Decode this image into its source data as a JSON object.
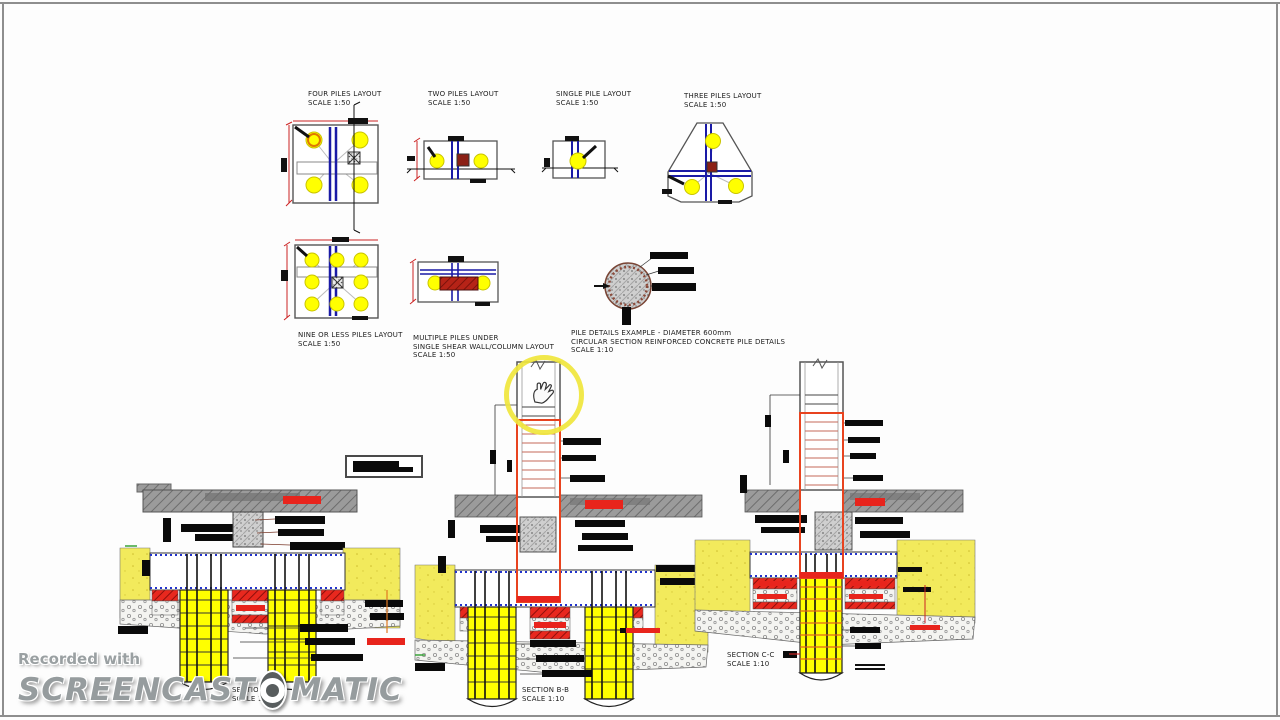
{
  "canvas": {
    "background": "#fdfdfd",
    "frame_color": "#8e8e8e"
  },
  "layouts": {
    "four": {
      "title": "FOUR PILES LAYOUT",
      "scale": "SCALE 1:50"
    },
    "two": {
      "title": "TWO PILES LAYOUT",
      "scale": "SCALE 1:50"
    },
    "single": {
      "title": "SINGLE PILE LAYOUT",
      "scale": "SCALE 1:50"
    },
    "three": {
      "title": "THREE PILES LAYOUT",
      "scale": "SCALE 1:50"
    },
    "nine": {
      "title": "NINE OR LESS PILES LAYOUT",
      "scale": "SCALE 1:50"
    },
    "multiple": {
      "title1": "MULTIPLE PILES UNDER",
      "title2": "SINGLE SHEAR WALL/COLUMN LAYOUT",
      "scale": "SCALE 1:50"
    },
    "pile_detail": {
      "title1": "PILE DETAILS EXAMPLE -  DIAMETER 600mm",
      "title2": "CIRCULAR SECTION REINFORCED CONCRETE PILE DETAILS",
      "scale": "SCALE 1:10"
    }
  },
  "sections": {
    "a": {
      "title": "SECTION A-A",
      "scale": "SCALE 1:10"
    },
    "b": {
      "title": "SECTION B-B",
      "scale": "SCALE 1:10"
    },
    "c": {
      "title": "SECTION C-C",
      "scale": "SCALE 1:10"
    }
  },
  "watermark": {
    "recorded": "Recorded with",
    "brand_a": "SCREENCAST",
    "brand_b": "MATIC"
  },
  "colors": {
    "pile_yellow": "#ffff00",
    "ground_yellow": "#f2ea5c",
    "rebar_red": "#e8241c",
    "wall_blue": "#1a1aa6",
    "column_orange": "#e8431f",
    "slab_gray": "#9b9b9b",
    "maroon": "#8b2015",
    "highlight_yellow": "#f0e63c",
    "cap_dash_blue": "#2233cc"
  }
}
